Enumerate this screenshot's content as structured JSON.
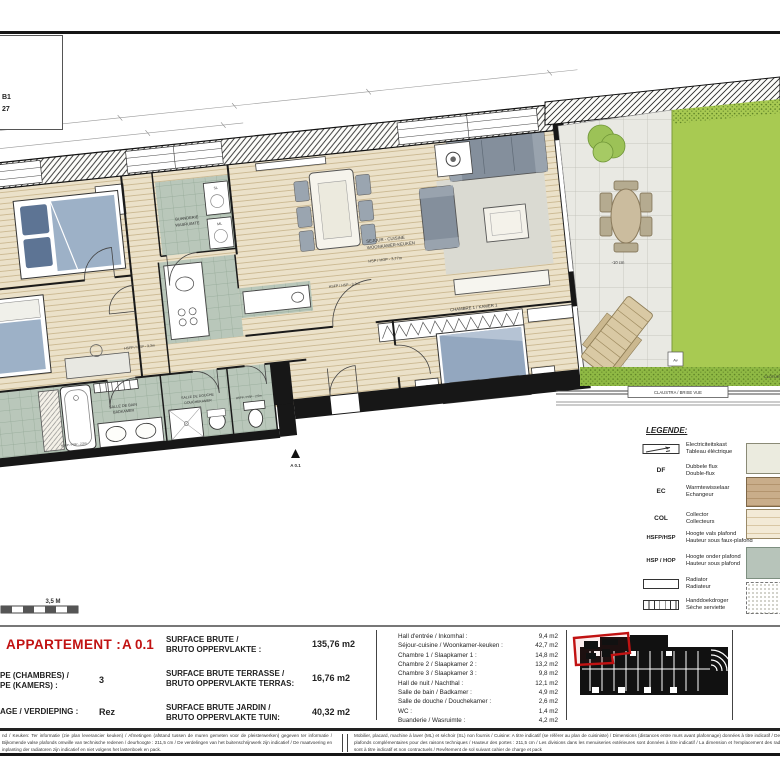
{
  "sheet": {
    "corner_code_line1": "B1",
    "corner_code_line2": "27",
    "scale_bar_label": "3,5 M",
    "entrance_marker": "A 0.1"
  },
  "plan": {
    "rooms": {
      "buanderie_line1": "BUANDERIE",
      "buanderie_line2": "WASRUIMTE",
      "sejour_line1": "SEJOUR - CUISINE",
      "sejour_line2": "WOONKAMER-KEUKEN",
      "sejour_height": "HSP / HOP - 3,77m",
      "ceiling_note_1": "HSFP / HSP - 3,3m",
      "ceiling_note_2": "HSFP / HSP - 3,3m",
      "chambre1": "CHAMBRE 1 / KAMER 1",
      "salle_de_bain_line1": "SALLE DE BAIN",
      "salle_de_bain_line2": "BADKAMER",
      "salle_de_douche_line1": "SALLE DE DOUCHE",
      "salle_de_douche_line2": "DOUCHEKAMER",
      "bath_height": "HSFP / HSP - 2,5m",
      "wc_height": "HSFP / HSP - 2,5m"
    },
    "appliances": {
      "dryer": "SL",
      "washer": "ML"
    },
    "outdoor": {
      "terrace_level": "-10 cm",
      "claustra": "CLAUSTRA / BRISE VUE",
      "cloture": "CLOTURE",
      "garden_marker": "Av"
    }
  },
  "legend": {
    "title": "LEGENDE:",
    "items": [
      {
        "code": "",
        "nl": "Electriciteitskast",
        "fr": "Tableau éléctrique"
      },
      {
        "code": "DF",
        "nl": "Dubbele flux",
        "fr": "Double-flux"
      },
      {
        "code": "EC",
        "nl": "Warmtewisselaar",
        "fr": "Echangeur"
      },
      {
        "code": "COL",
        "nl": "Collector",
        "fr": "Collecteurs"
      },
      {
        "code": "HSFP/HSP",
        "nl": "Hoogte vals plafond",
        "fr": "Hauteur sous faux-plafond"
      },
      {
        "code": "HSP / HOP",
        "nl": "Hoogte onder plafond",
        "fr": "Hauteur sous plafond"
      },
      {
        "code": "",
        "nl": "Radiator",
        "fr": "Radiateur"
      },
      {
        "code": "",
        "nl": "Handdoekdroger",
        "fr": "Sèche serviette"
      }
    ],
    "swatches": [
      "floor-cream",
      "floor-wood",
      "floor-parquet",
      "floor-tile-sage",
      "floor-dotted"
    ]
  },
  "title_block": {
    "apartment_label": "APPARTEMENT :",
    "apartment_value": "A 0.1",
    "type_label_line1": "PE (CHAMBRES) /",
    "type_label_line2": "PE (KAMERS) :",
    "type_value": "3",
    "floor_label": "AGE / VERDIEPING :",
    "floor_value": "Rez",
    "surfaces": [
      {
        "label_line1": "SURFACE BRUTE /",
        "label_line2": "BRUTO OPPERVLAKTE :",
        "value": "135,76 m2"
      },
      {
        "label_line1": "SURFACE BRUTE TERRASSE /",
        "label_line2": "BRUTO OPPERVLAKTE TERRAS:",
        "value": "16,76 m2"
      },
      {
        "label_line1": "SURFACE BRUTE JARDIN /",
        "label_line2": "BRUTO OPPERVLAKTE TUIN:",
        "value": "40,32 m2"
      }
    ],
    "room_areas": [
      {
        "label": "Hall d'entrée / Inkomhal :",
        "value": "9,4 m2"
      },
      {
        "label": "Séjour-cuisine / Woonkamer-keuken :",
        "value": "42,7 m2"
      },
      {
        "label": "Chambre 1 / Slaapkamer 1 :",
        "value": "14,8 m2"
      },
      {
        "label": "Chambre 2 / Slaapkamer 2 :",
        "value": "13,2 m2"
      },
      {
        "label": "Chambre 3 / Slaapkamer 3 :",
        "value": "9,8 m2"
      },
      {
        "label": "Hall de nuit / Nachthal :",
        "value": "12,1 m2"
      },
      {
        "label": "Salle de bain / Badkamer :",
        "value": "4,9 m2"
      },
      {
        "label": "Salle de douche / Douchekamer :",
        "value": "2,6 m2"
      },
      {
        "label": "WC :",
        "value": "1,4 m2"
      },
      {
        "label": "Buanderie / Wasruimte :",
        "value": "4,2 m2"
      }
    ]
  },
  "disclaimers": {
    "dutch": "nd / Keuken: Ter informatie (zie plan leverancier keuken) / Afmetingen (afstand tussen de muren gemeten voor de pleisterwerken) gegeven ter informatie / Bijkomende valse plafonds omwille van technische redenen / deurhoogte : 211,5 cm / De verdelingen van het buitenschrijnwerk zijn indicatief / De maatvoering en inplanting der radiatoren zijn indicatief en niet volgens het lastenboek en pack.",
    "french": "Mobilier, placard, machine à laver (ML) et séchoir (SL) non fournis / Cuisine: A titre indicatif (se référer au plan de cuisiniste) / Dimensions (distances entre murs avant plafonnage) données à titre indicatif / Des faux-plafonds complémentaires pour des raisons techniques / Hauteur des portes : 211,5 cm / Les divisions dans les menuiseries extérieures sont données à titre indicatif / La dimension et l'emplacement des radiateurs sont à titre indicatif et non contractuels / Revêtement de sol suivant cahier de charge et pack"
  },
  "colors": {
    "accent_red": "#c11212",
    "garden_green": "#a8ca52",
    "hedge_green": "#8fb944",
    "tile_green": "#b9c7ba",
    "wood_floor": "#ebe1c9",
    "terrace_tile": "#e9e9e3"
  }
}
